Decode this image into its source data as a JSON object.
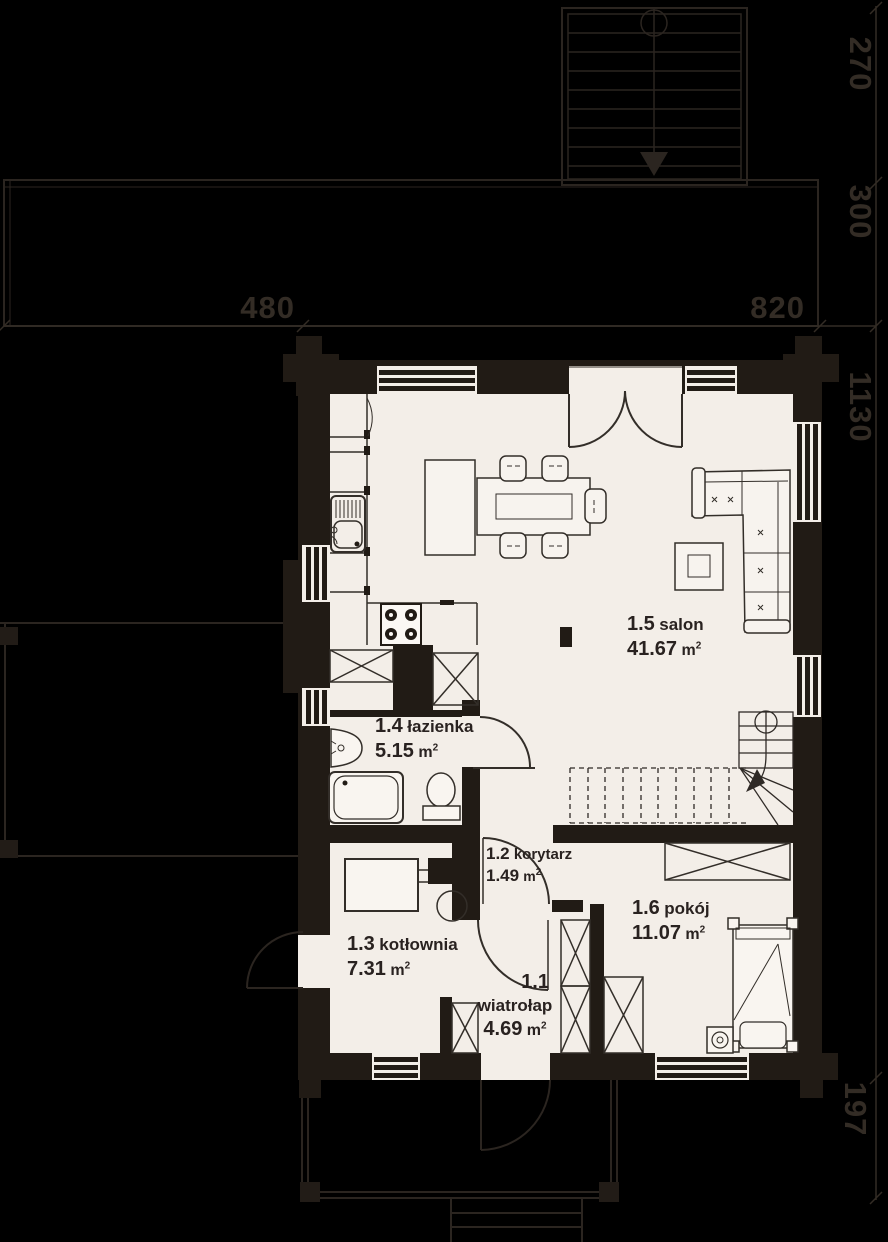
{
  "plan": {
    "type": "floor-plan",
    "language": "pl",
    "rooms": [
      {
        "id": "1.5",
        "name": "salon",
        "area": "41.67",
        "unit": "m",
        "sup": "2"
      },
      {
        "id": "1.4",
        "name": "łazienka",
        "area": "5.15",
        "unit": "m",
        "sup": "2"
      },
      {
        "id": "1.2",
        "name": "korytarz",
        "area": "1.49",
        "unit": "m",
        "sup": "2"
      },
      {
        "id": "1.3",
        "name": "kotłownia",
        "area": "7.31",
        "unit": "m",
        "sup": "2"
      },
      {
        "id": "1.1",
        "name": "wiatrołap",
        "area": "4.69",
        "unit": "m",
        "sup": "2"
      },
      {
        "id": "1.6",
        "name": "pokój",
        "area": "11.07",
        "unit": "m",
        "sup": "2"
      }
    ],
    "dimensions": {
      "external_stairs_depth": "270",
      "upper_terrace_depth": "300",
      "width_left": "480",
      "width_right": "820",
      "house_depth": "1130",
      "porch_depth": "197"
    },
    "colors": {
      "background": "#000000",
      "wall": "#211b15",
      "floor": "#f3eee8",
      "outside_line": "#2b2520",
      "dim_text": "#332c25",
      "label_text": "#292220",
      "furniture_stroke": "#332e29"
    }
  }
}
